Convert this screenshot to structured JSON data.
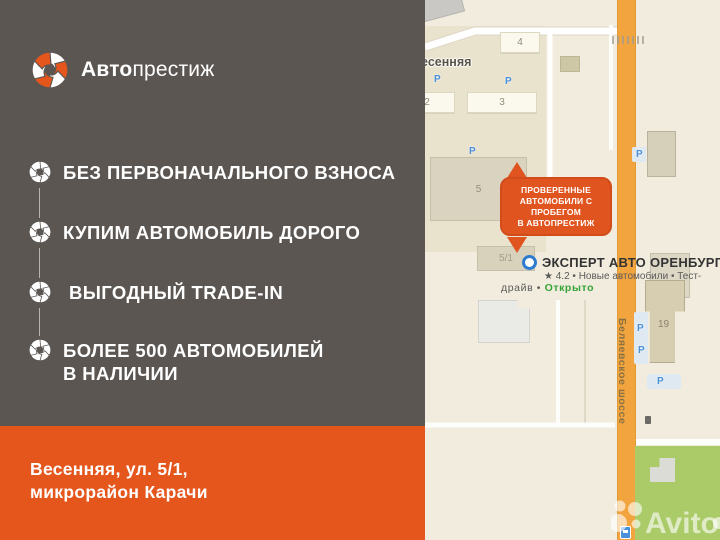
{
  "brand": {
    "name_bold": "Авто",
    "name_light": "престиж"
  },
  "benefits": {
    "items": [
      {
        "label": "БЕЗ ПЕРВОНАЧАЛЬНОГО ВЗНОСА"
      },
      {
        "label": "КУПИМ АВТОМОБИЛЬ ДОРОГО"
      },
      {
        "label": " ВЫГОДНЫЙ TRADE-IN"
      },
      {
        "label": "БОЛЕЕ 500 АВТОМОБИЛЕЙ",
        "label2": "В НАЛИЧИИ"
      }
    ]
  },
  "footer": {
    "address_line1": "Весенняя, ул. 5/1,",
    "address_line2": "микрорайон Карачи"
  },
  "map": {
    "street_label": "Весенняя",
    "road_label": "Беляевское шоссе",
    "buildings": {
      "b4": "4",
      "b2": "2",
      "b3": "3",
      "b5": "5",
      "b5_1": "5/1",
      "b19": "19"
    },
    "parking_label": "P",
    "callout": {
      "line1": "ПРОВЕРЕННЫЕ",
      "line2": "АВТОМОБИЛИ С ПРОБЕГОМ",
      "line3": "В АВТОПРЕСТИЖ"
    },
    "poi": {
      "title": "ЭКСПЕРТ АВТО ОРЕНБУРГ",
      "rating_line": "★ 4.2 • Новые автомобили • Тест-",
      "status_prefix": "драйв • ",
      "status": "Открыто"
    },
    "watermark": "Avito"
  },
  "icons": {
    "logo": "swirl-icon",
    "bullet": "swirl-icon",
    "marker": "ring-marker-icon",
    "parking": "parking-icon",
    "bus": "bus-stop-icon"
  },
  "colors": {
    "panel_gray": "#5b5652",
    "accent_orange": "#e5561d",
    "callout_orange": "#e0541f",
    "road_orange": "#f2a43e",
    "status_green": "#36a336",
    "parking_blue": "#4a90d9",
    "park_green": "#aacb68"
  }
}
